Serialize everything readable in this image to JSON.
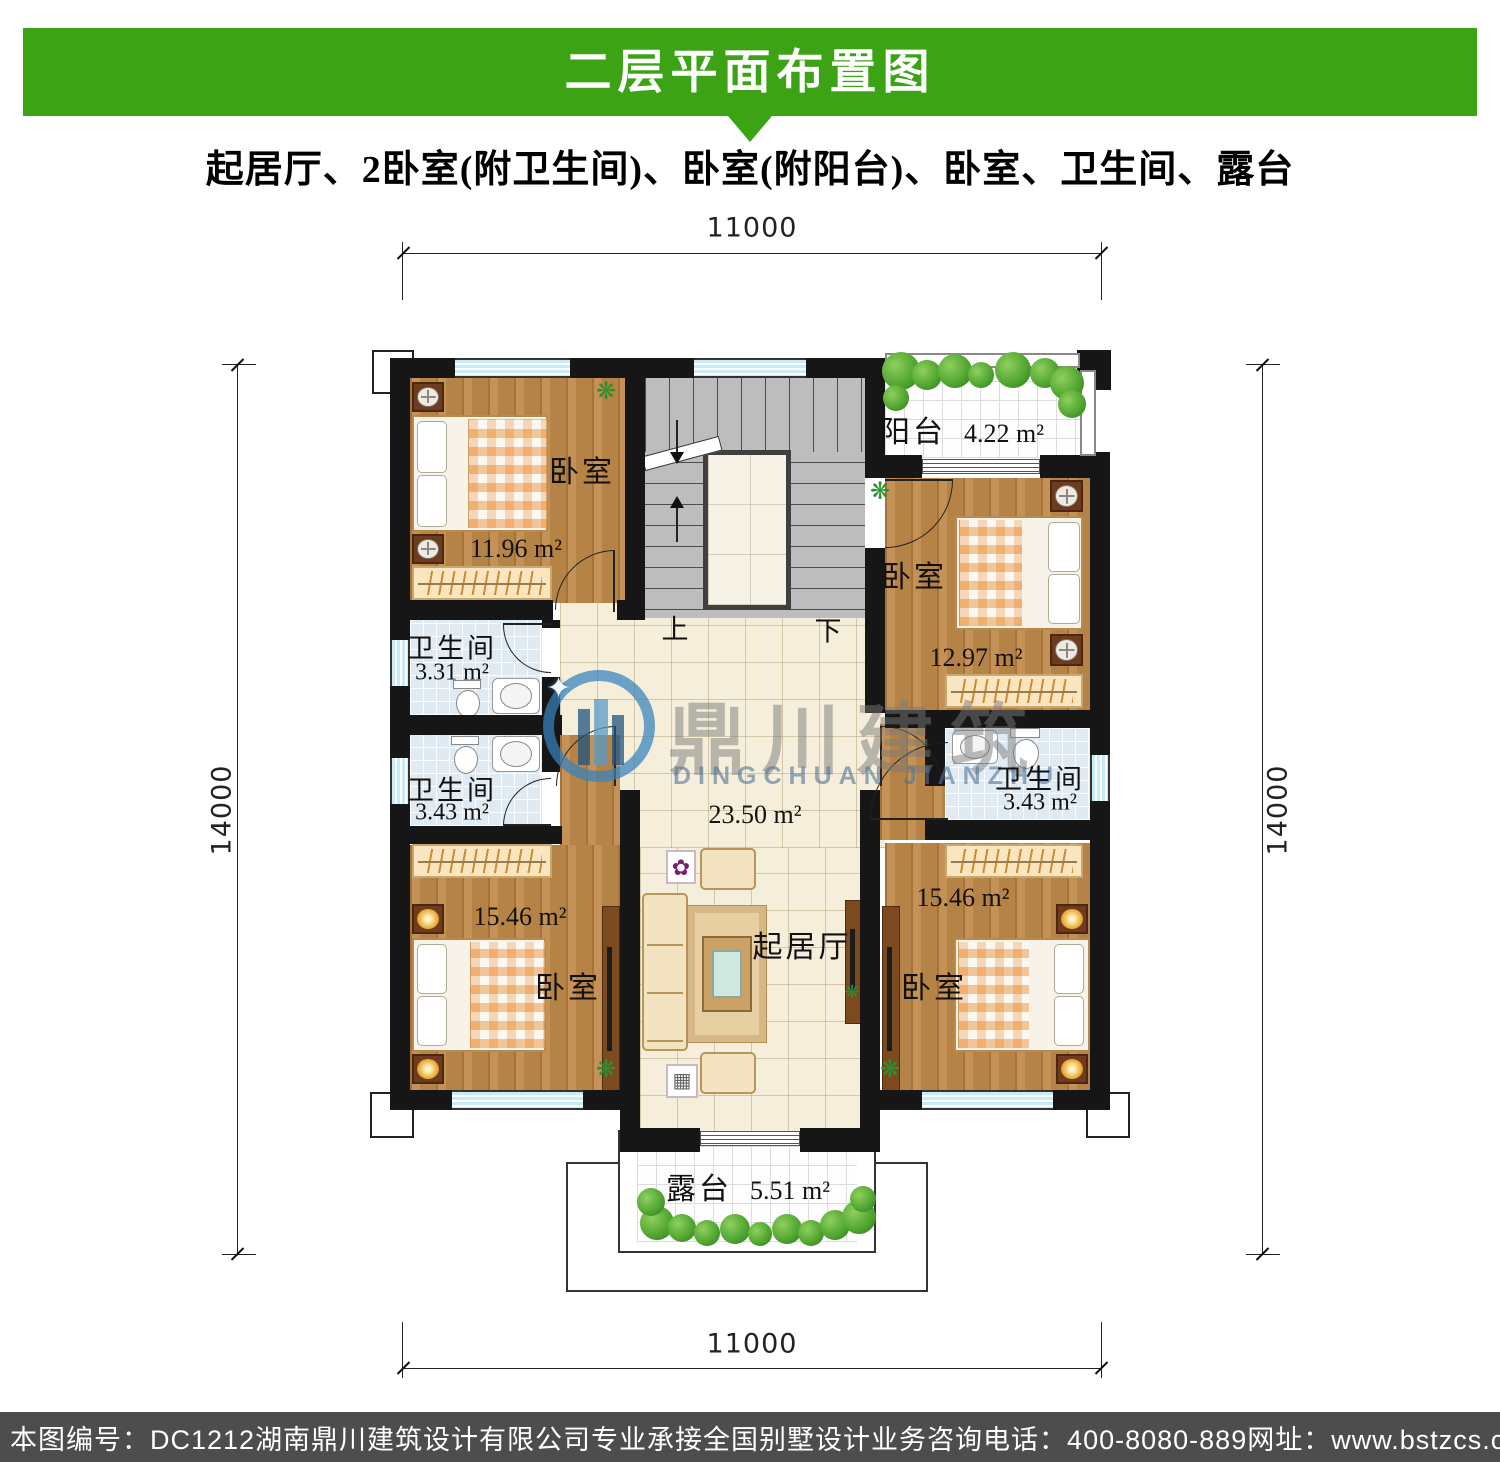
{
  "header": {
    "title": "二层平面布置图",
    "subtitle": "起居厅、2卧室(附卫生间)、卧室(附阳台)、卧室、卫生间、露台"
  },
  "dimensions": {
    "top": "11000",
    "bottom": "11000",
    "left": "14000",
    "right": "14000"
  },
  "rooms": {
    "bedroom_top_left": {
      "name": "卧室",
      "area": "11.96 m²"
    },
    "bedroom_right": {
      "name": "卧室",
      "area": "12.97 m²"
    },
    "bedroom_bottom_left": {
      "name": "卧室",
      "area": "15.46 m²"
    },
    "bedroom_bottom_right": {
      "name": "卧室",
      "area": "15.46 m²"
    },
    "living_room": {
      "name": "起居厅",
      "area": "23.50 m²"
    },
    "balcony": {
      "name": "阳台",
      "area": "4.22 m²"
    },
    "bathroom_left_top": {
      "name": "卫生间",
      "area": "3.31 m²"
    },
    "bathroom_left_bottom": {
      "name": "卫生间",
      "area": "3.43 m²"
    },
    "bathroom_right": {
      "name": "卫生间",
      "area": "3.43 m²"
    },
    "terrace": {
      "name": "露台",
      "area": "5.51 m²"
    }
  },
  "stairs": {
    "up_label": "上",
    "down_label": "下"
  },
  "watermark": {
    "name_cn": "鼎川建筑",
    "name_en": "DINGCHUAN JIANZHU"
  },
  "icons": {
    "plant": "❋",
    "sparkle": "✦",
    "flower": "✿",
    "appliance": "▦"
  },
  "footer": {
    "drawing_no": "本图编号：DC1212",
    "company": "湖南鼎川建筑设计有限公司专业承接全国别墅设计业务",
    "phone": "咨询电话：400-8080-889",
    "website": "网址：www.bstzcs.com"
  },
  "colors": {
    "banner_green": "#3ca315",
    "footer_gray": "#4d4d4d",
    "watermark_blue": "#3482bc",
    "wall_black": "#161616",
    "window_cyan": "#c7ecf8"
  }
}
